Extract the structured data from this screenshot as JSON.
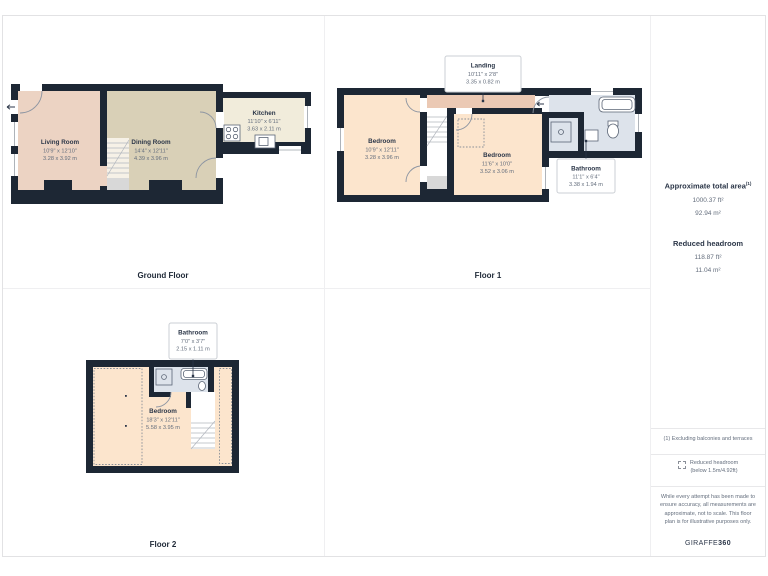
{
  "floors": [
    {
      "label": "Ground Floor",
      "rooms": [
        {
          "name": "Living Room",
          "dims_ft": "10'9\" x 12'10\"",
          "dims_m": "3.28 x 3.92 m"
        },
        {
          "name": "Dining Room",
          "dims_ft": "14'4\" x 12'11\"",
          "dims_m": "4.39 x 3.96 m"
        },
        {
          "name": "Kitchen",
          "dims_ft": "11'10\" x 6'11\"",
          "dims_m": "3.63 x 2.11 m"
        }
      ]
    },
    {
      "label": "Floor 1",
      "rooms": [
        {
          "name": "Landing",
          "dims_ft": "10'11\" x 2'8\"",
          "dims_m": "3.35 x 0.82 m"
        },
        {
          "name": "Bedroom",
          "dims_ft": "10'9\" x 12'11\"",
          "dims_m": "3.28 x 3.96 m"
        },
        {
          "name": "Bedroom",
          "dims_ft": "11'6\" x 10'0\"",
          "dims_m": "3.52 x 3.06 m"
        },
        {
          "name": "Bathroom",
          "dims_ft": "11'1\" x 6'4\"",
          "dims_m": "3.38 x 1.94 m"
        }
      ]
    },
    {
      "label": "Floor 2",
      "rooms": [
        {
          "name": "Bathroom",
          "dims_ft": "7'0\" x 3'7\"",
          "dims_m": "2.15 x 1.11 m"
        },
        {
          "name": "Bedroom",
          "dims_ft": "18'3\" x 12'11\"",
          "dims_m": "5.58 x 3.95 m"
        }
      ]
    }
  ],
  "sidebar": {
    "total_area_title": "Approximate total area",
    "total_area_sup": "(1)",
    "total_area_ft": "1000.37 ft²",
    "total_area_m": "92.94 m²",
    "reduced_title": "Reduced headroom",
    "reduced_ft": "118.87 ft²",
    "reduced_m": "11.04 m²",
    "footnote": "(1) Excluding balconies and terraces",
    "legend_line1": "Reduced headroom",
    "legend_line2": "(below 1.5m/4.92ft)",
    "disclaimer": "While every attempt has been made to ensure accuracy, all measurements are approximate, not to scale. This floor plan is for illustrative purposes only.",
    "brand_normal": "GIRAFFE",
    "brand_bold": "360"
  },
  "colors": {
    "wall": "#1d2734",
    "living": "#ecd3c3",
    "dining": "#d9d0b7",
    "kitchen": "#f1ecdb",
    "bedroom": "#fce5cd",
    "landing": "#ebc9b4",
    "bathroom": "#dde3eb",
    "stairs_gray": "#d8d8d8",
    "text_dark": "#2b3648",
    "text_muted": "#646e7d"
  }
}
